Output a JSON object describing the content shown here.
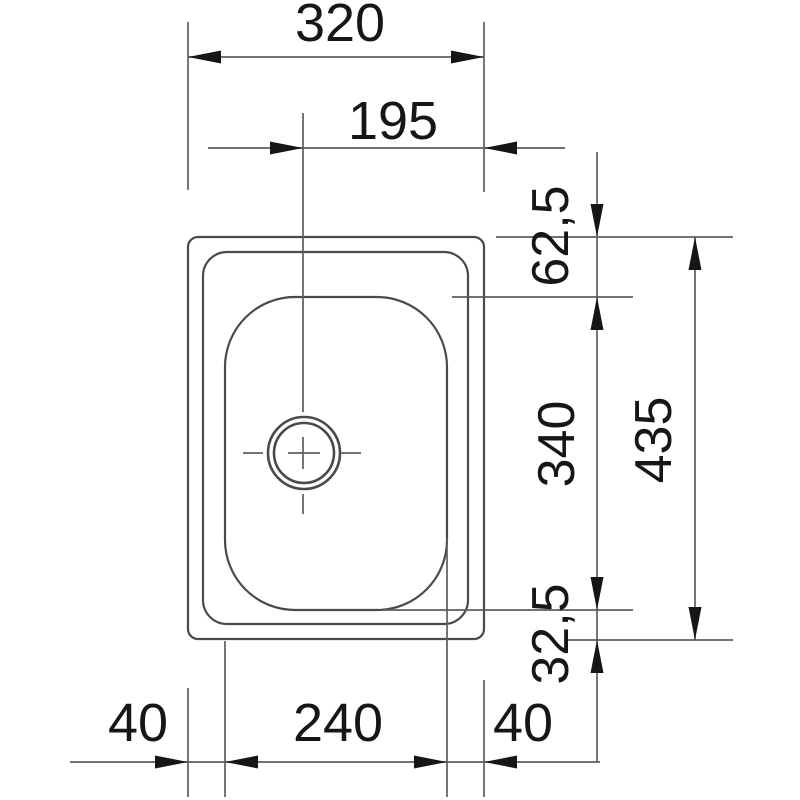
{
  "drawing": {
    "type": "sink-installation-dimension-drawing",
    "units": "mm",
    "labels": {
      "overall_width": "320",
      "drain_center_to_right_edge": "195",
      "top_edge_to_bowl": "62,5",
      "bowl_height": "340",
      "overall_height": "435",
      "bowl_to_bottom_edge": "32,5",
      "left_margin": "40",
      "bowl_width": "240",
      "right_margin": "40"
    },
    "colors": {
      "outline": "#4a4a4a",
      "dim_line": "#5e5e5e",
      "arrow": "#161616",
      "text": "#161616",
      "background": "#ffffff"
    }
  }
}
